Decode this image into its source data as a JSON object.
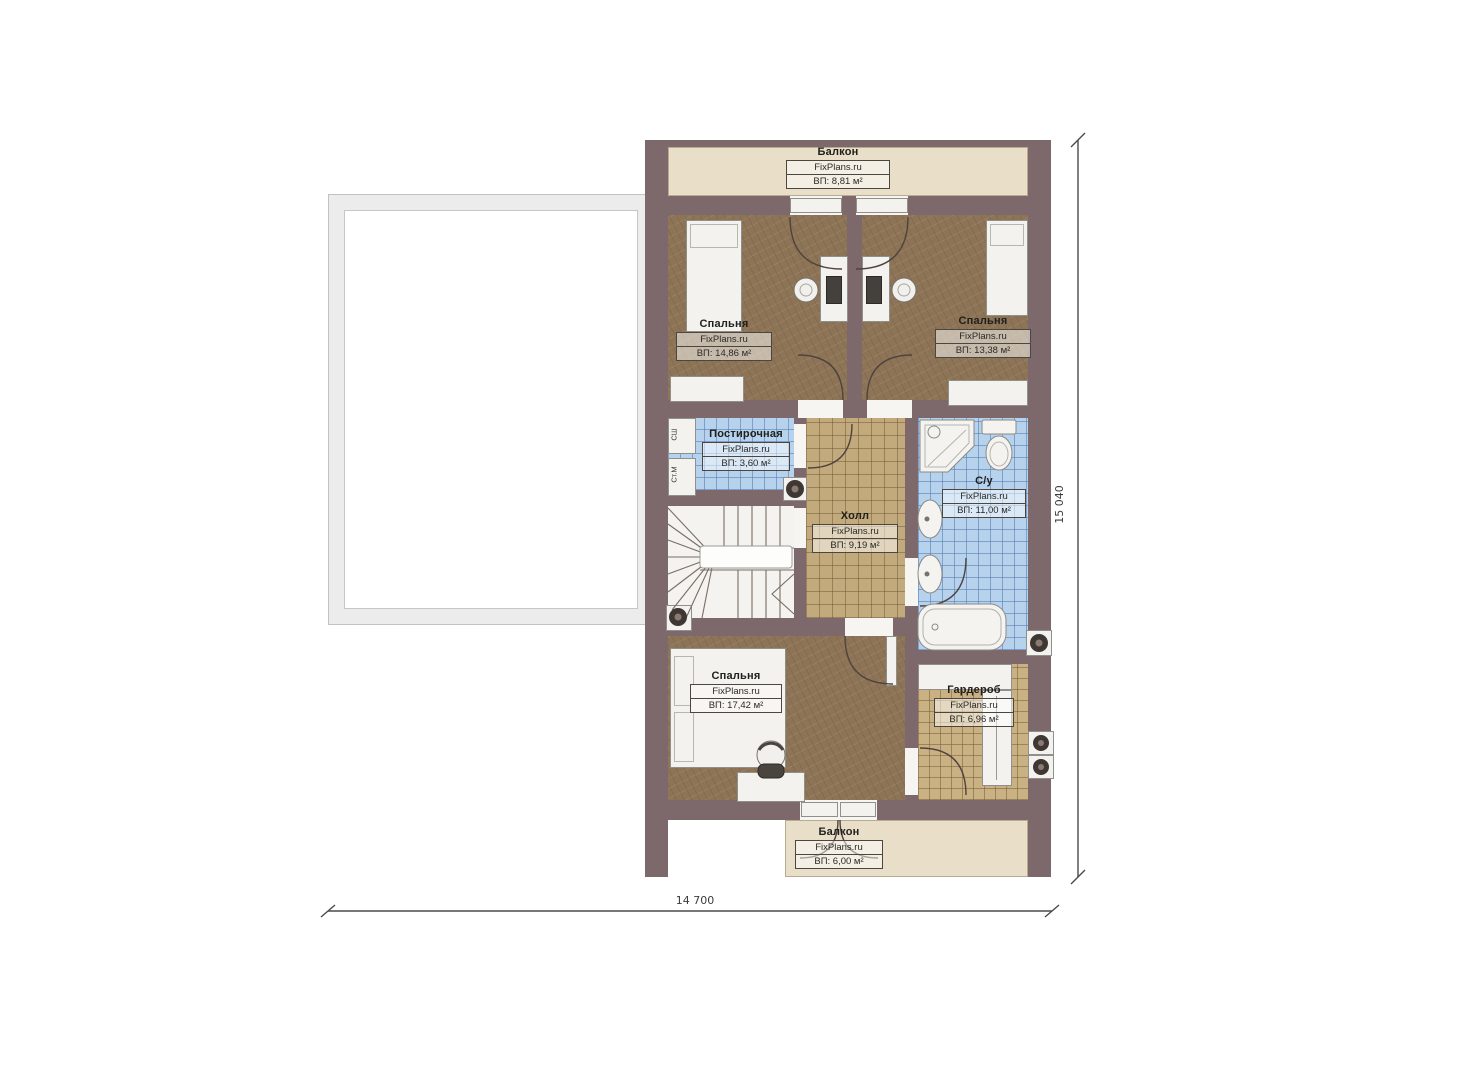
{
  "plan": {
    "title": "Floor plan — second floor",
    "brand": "FixPlans.ru",
    "rooms": [
      {
        "key": "balcony-top",
        "name": "Балкон",
        "brand": "FixPlans.ru",
        "area": "ВП: 8,81 м²"
      },
      {
        "key": "bedroom-top-left",
        "name": "Спальня",
        "brand": "FixPlans.ru",
        "area": "ВП: 14,86 м²"
      },
      {
        "key": "bedroom-top-right",
        "name": "Спальня",
        "brand": "FixPlans.ru",
        "area": "ВП: 13,38 м²"
      },
      {
        "key": "laundry",
        "name": "Постирочная",
        "brand": "FixPlans.ru",
        "area": "ВП: 3,60 м²"
      },
      {
        "key": "hall",
        "name": "Холл",
        "brand": "FixPlans.ru",
        "area": "ВП: 9,19 м²"
      },
      {
        "key": "bathroom",
        "name": "С/у",
        "brand": "FixPlans.ru",
        "area": "ВП: 11,00 м²"
      },
      {
        "key": "bedroom-bottom",
        "name": "Спальня",
        "brand": "FixPlans.ru",
        "area": "ВП: 17,42 м²"
      },
      {
        "key": "wardrobe",
        "name": "Гардероб",
        "brand": "FixPlans.ru",
        "area": "ВП: 6,96 м²"
      },
      {
        "key": "balcony-bottom",
        "name": "Балкон",
        "brand": "FixPlans.ru",
        "area": "ВП: 6,00 м²"
      }
    ],
    "appliances": {
      "dryer": "СШ",
      "washer": "Ст.М"
    },
    "dimensions": {
      "horizontal": "14 700",
      "vertical": "15 040"
    },
    "colors": {
      "wall": "#7d696b",
      "wood_floor": "#8d7456",
      "tile_blue": "#b7d2ec",
      "tile_tan": "#c2aa7d",
      "tile_wardrobe": "#c9b183",
      "balcony": "#e9dec8",
      "furniture": "#f3f2ef",
      "terrace_frame": "#ececec"
    }
  }
}
